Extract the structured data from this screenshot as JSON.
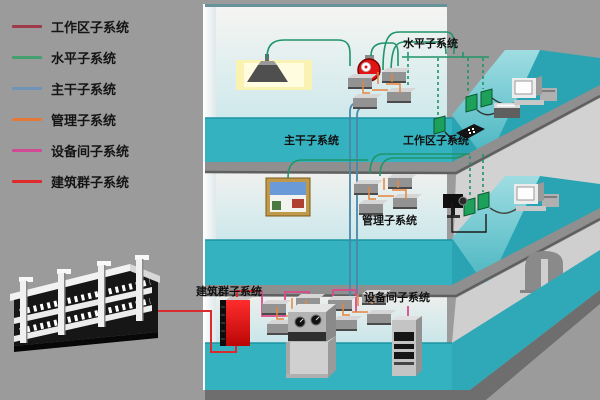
{
  "legend": {
    "items": [
      {
        "label": "工作区子系统",
        "color": "#9e3a4a"
      },
      {
        "label": "水平子系统",
        "color": "#44a06e"
      },
      {
        "label": "主干子系统",
        "color": "#6f94b8"
      },
      {
        "label": "管理子系统",
        "color": "#e5793a"
      },
      {
        "label": "设备间子系统",
        "color": "#d04a94"
      },
      {
        "label": "建筑群子系统",
        "color": "#e02a2a"
      }
    ]
  },
  "diagram": {
    "labels": {
      "horizontal": "水平子系统",
      "backbone": "主干子系统",
      "workarea": "工作区子系统",
      "management": "管理子系统",
      "campus": "建筑群子系统",
      "equipment": "设备间子系统"
    },
    "colors": {
      "background": "#9b9b9b",
      "floor_teal": "#35b2c0",
      "floor_teal_dark": "#2aa4b2",
      "slab_gray": "#8f8f8f",
      "horizontal_cable": "#1f9468",
      "backbone_cable": "#4a88a8",
      "management_cable": "#e8843c",
      "equipment_cable": "#d94a8a",
      "campus_cable": "#d92b2b"
    }
  }
}
